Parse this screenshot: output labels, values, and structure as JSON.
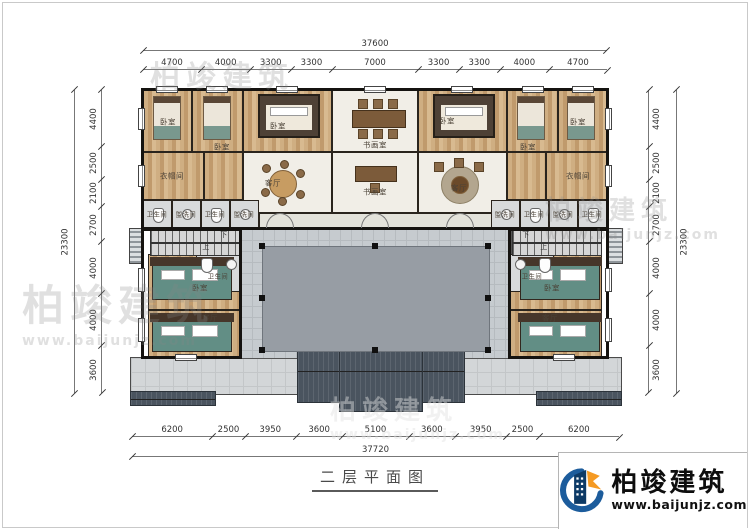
{
  "title": "二层平面图",
  "brand": {
    "name": "柏竣建筑",
    "url": "www.baijunjz.com"
  },
  "watermark": {
    "name": "柏竣建筑",
    "url": "www.baijunjz.com"
  },
  "dimensions": {
    "top_total": "37600",
    "top": [
      "4700",
      "4000",
      "3300",
      "3300",
      "7000",
      "3300",
      "3300",
      "4000",
      "4700"
    ],
    "left_total": "23300",
    "left": [
      "4400",
      "2500",
      "2100",
      "2700",
      "4000",
      "4000",
      "3600"
    ],
    "right_total": "23300",
    "right": [
      "4400",
      "2500",
      "2100",
      "2700",
      "4000",
      "4000",
      "3600"
    ],
    "bottom": [
      "6200",
      "2500",
      "3950",
      "3600",
      "5100",
      "3600",
      "3950",
      "2500",
      "6200"
    ],
    "bottom_total": "37720"
  },
  "rooms": {
    "bedroom": "卧室",
    "study": "书画室",
    "living": "客厅",
    "cloakroom": "衣帽间",
    "bathroom": "卫生间",
    "washroom": "盥洗间",
    "stair_down": "下",
    "stair_up": "上"
  }
}
